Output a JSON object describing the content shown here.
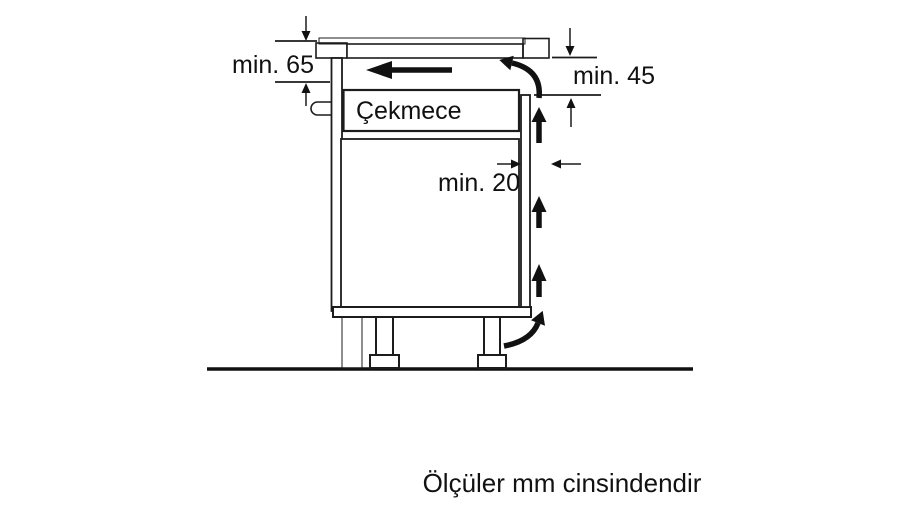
{
  "diagram": {
    "labels": {
      "drawer": "Çekmece",
      "min65": "min. 65",
      "min45": "min. 45",
      "min20": "min. 20"
    },
    "caption": "Ölçüler mm cinsindendir",
    "colors": {
      "background": "#ffffff",
      "line": "#1c1c1c",
      "wall_fill": "#a6a6a6",
      "worktop_fill": "#cccccc",
      "hob_glass_fill": "#4a4a4a",
      "drawer_fill": "#dcdcdc",
      "plinth_fill": "#8d8d8d",
      "bracket_fill": "#c2c2c2",
      "arrow_color": "#111111",
      "text_color": "#111111"
    }
  }
}
